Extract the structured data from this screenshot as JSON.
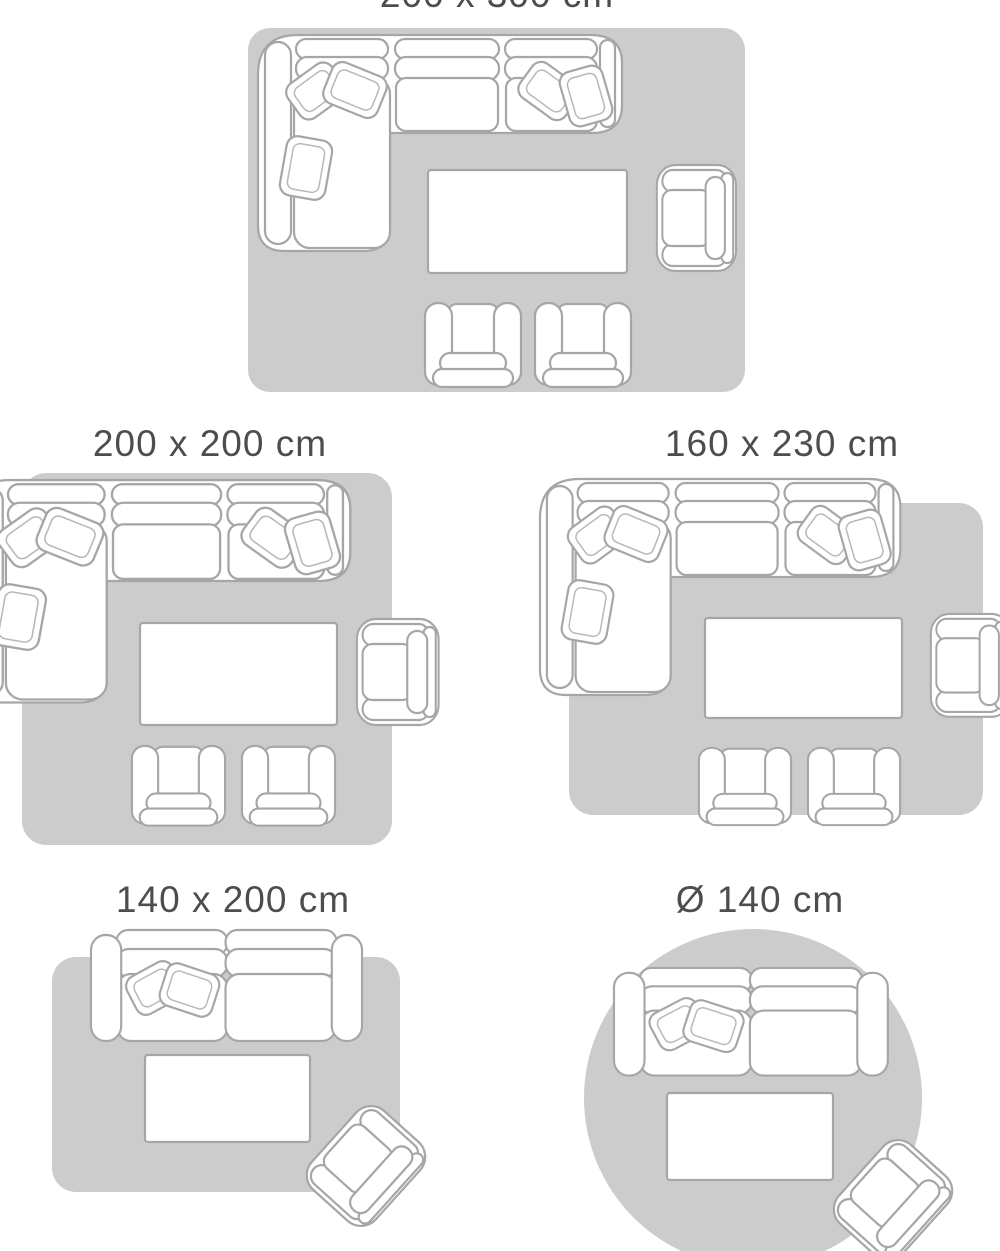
{
  "title": "Rug size guide with living-room furniture layouts",
  "panels": [
    {
      "id": "200x300",
      "label": "200 x 300 cm",
      "rug_shape": "rectangle"
    },
    {
      "id": "200x200",
      "label": "200 x 200 cm",
      "rug_shape": "square"
    },
    {
      "id": "160x230",
      "label": "160 x 230 cm",
      "rug_shape": "rectangle"
    },
    {
      "id": "140x200",
      "label": "140 x 200 cm",
      "rug_shape": "rectangle"
    },
    {
      "id": "d140",
      "label": "Ø 140 cm",
      "rug_shape": "circle"
    }
  ],
  "colors": {
    "background": "#ffffff",
    "rug": "#cccccc",
    "furniture": "#ffffff",
    "outline": "#a6a6a6",
    "label": "#4d4d4d"
  }
}
